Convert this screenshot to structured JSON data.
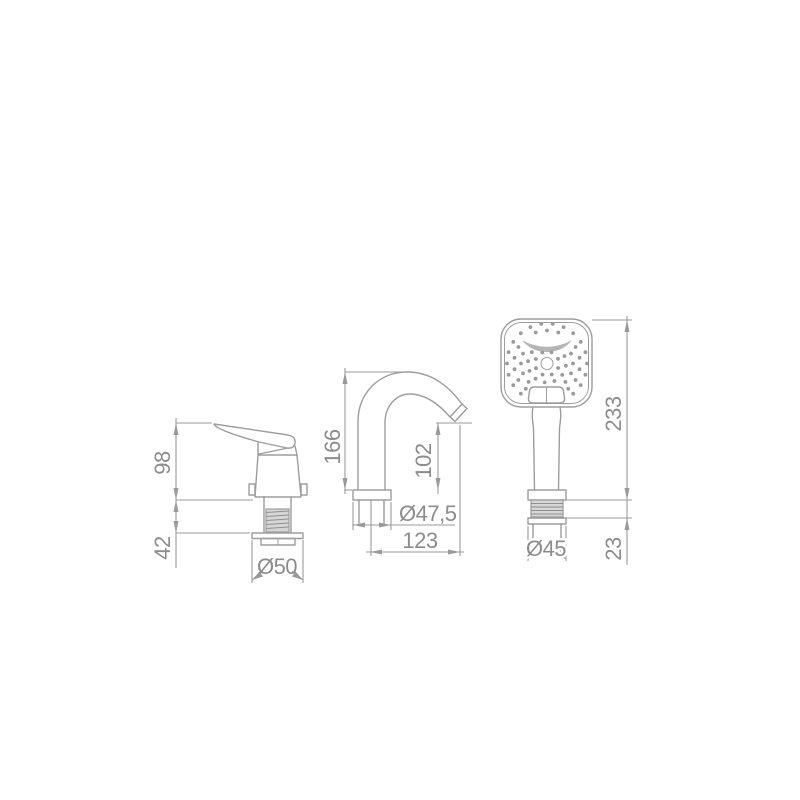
{
  "colors": {
    "background": "#ffffff",
    "line": "#9d9d9d",
    "dimension_line": "#9a9a9a",
    "text": "#8c8c8c",
    "fill_light": "#d6d6d6",
    "fill_mid": "#b5b5b5"
  },
  "drawing": {
    "type": "technical-dimension-drawing",
    "views": [
      {
        "id": "mixer",
        "name": "single-lever mixer, side view",
        "dimensions": [
          {
            "label": "98",
            "orientation": "vertical"
          },
          {
            "label": "42",
            "orientation": "vertical"
          },
          {
            "label": "Ø50",
            "orientation": "diameter"
          }
        ]
      },
      {
        "id": "spout",
        "name": "curved tub spout, side view",
        "dimensions": [
          {
            "label": "166",
            "orientation": "vertical"
          },
          {
            "label": "102",
            "orientation": "vertical"
          },
          {
            "label": "Ø47,5",
            "orientation": "diameter"
          },
          {
            "label": "123",
            "orientation": "horizontal"
          }
        ]
      },
      {
        "id": "handshower",
        "name": "hand shower, front view",
        "dimensions": [
          {
            "label": "233",
            "orientation": "vertical"
          },
          {
            "label": "Ø45",
            "orientation": "diameter"
          },
          {
            "label": "23",
            "orientation": "vertical"
          }
        ]
      }
    ],
    "spray_pattern": {
      "center": {
        "x": 547,
        "y": 363.5
      },
      "dot_radius": 1.9,
      "rings": [
        {
          "r": 12,
          "count": 8,
          "offset": 22
        },
        {
          "r": 19,
          "count": 12,
          "offset": 7
        },
        {
          "r": 26,
          "count": 16,
          "offset": 0
        },
        {
          "r": 33,
          "count": 18,
          "offset": 10
        },
        {
          "r": 40,
          "count": 22,
          "offset": 0
        }
      ],
      "bounds_ellipse": {
        "a": 42,
        "b": 40
      },
      "exclusions": {
        "band": {
          "x1": 520,
          "y1": 336,
          "x2": 574,
          "y2": 352
        },
        "button": {
          "x1": 526,
          "y1": 384,
          "x2": 566,
          "y2": 404
        },
        "center_hole_r": 9
      }
    }
  }
}
